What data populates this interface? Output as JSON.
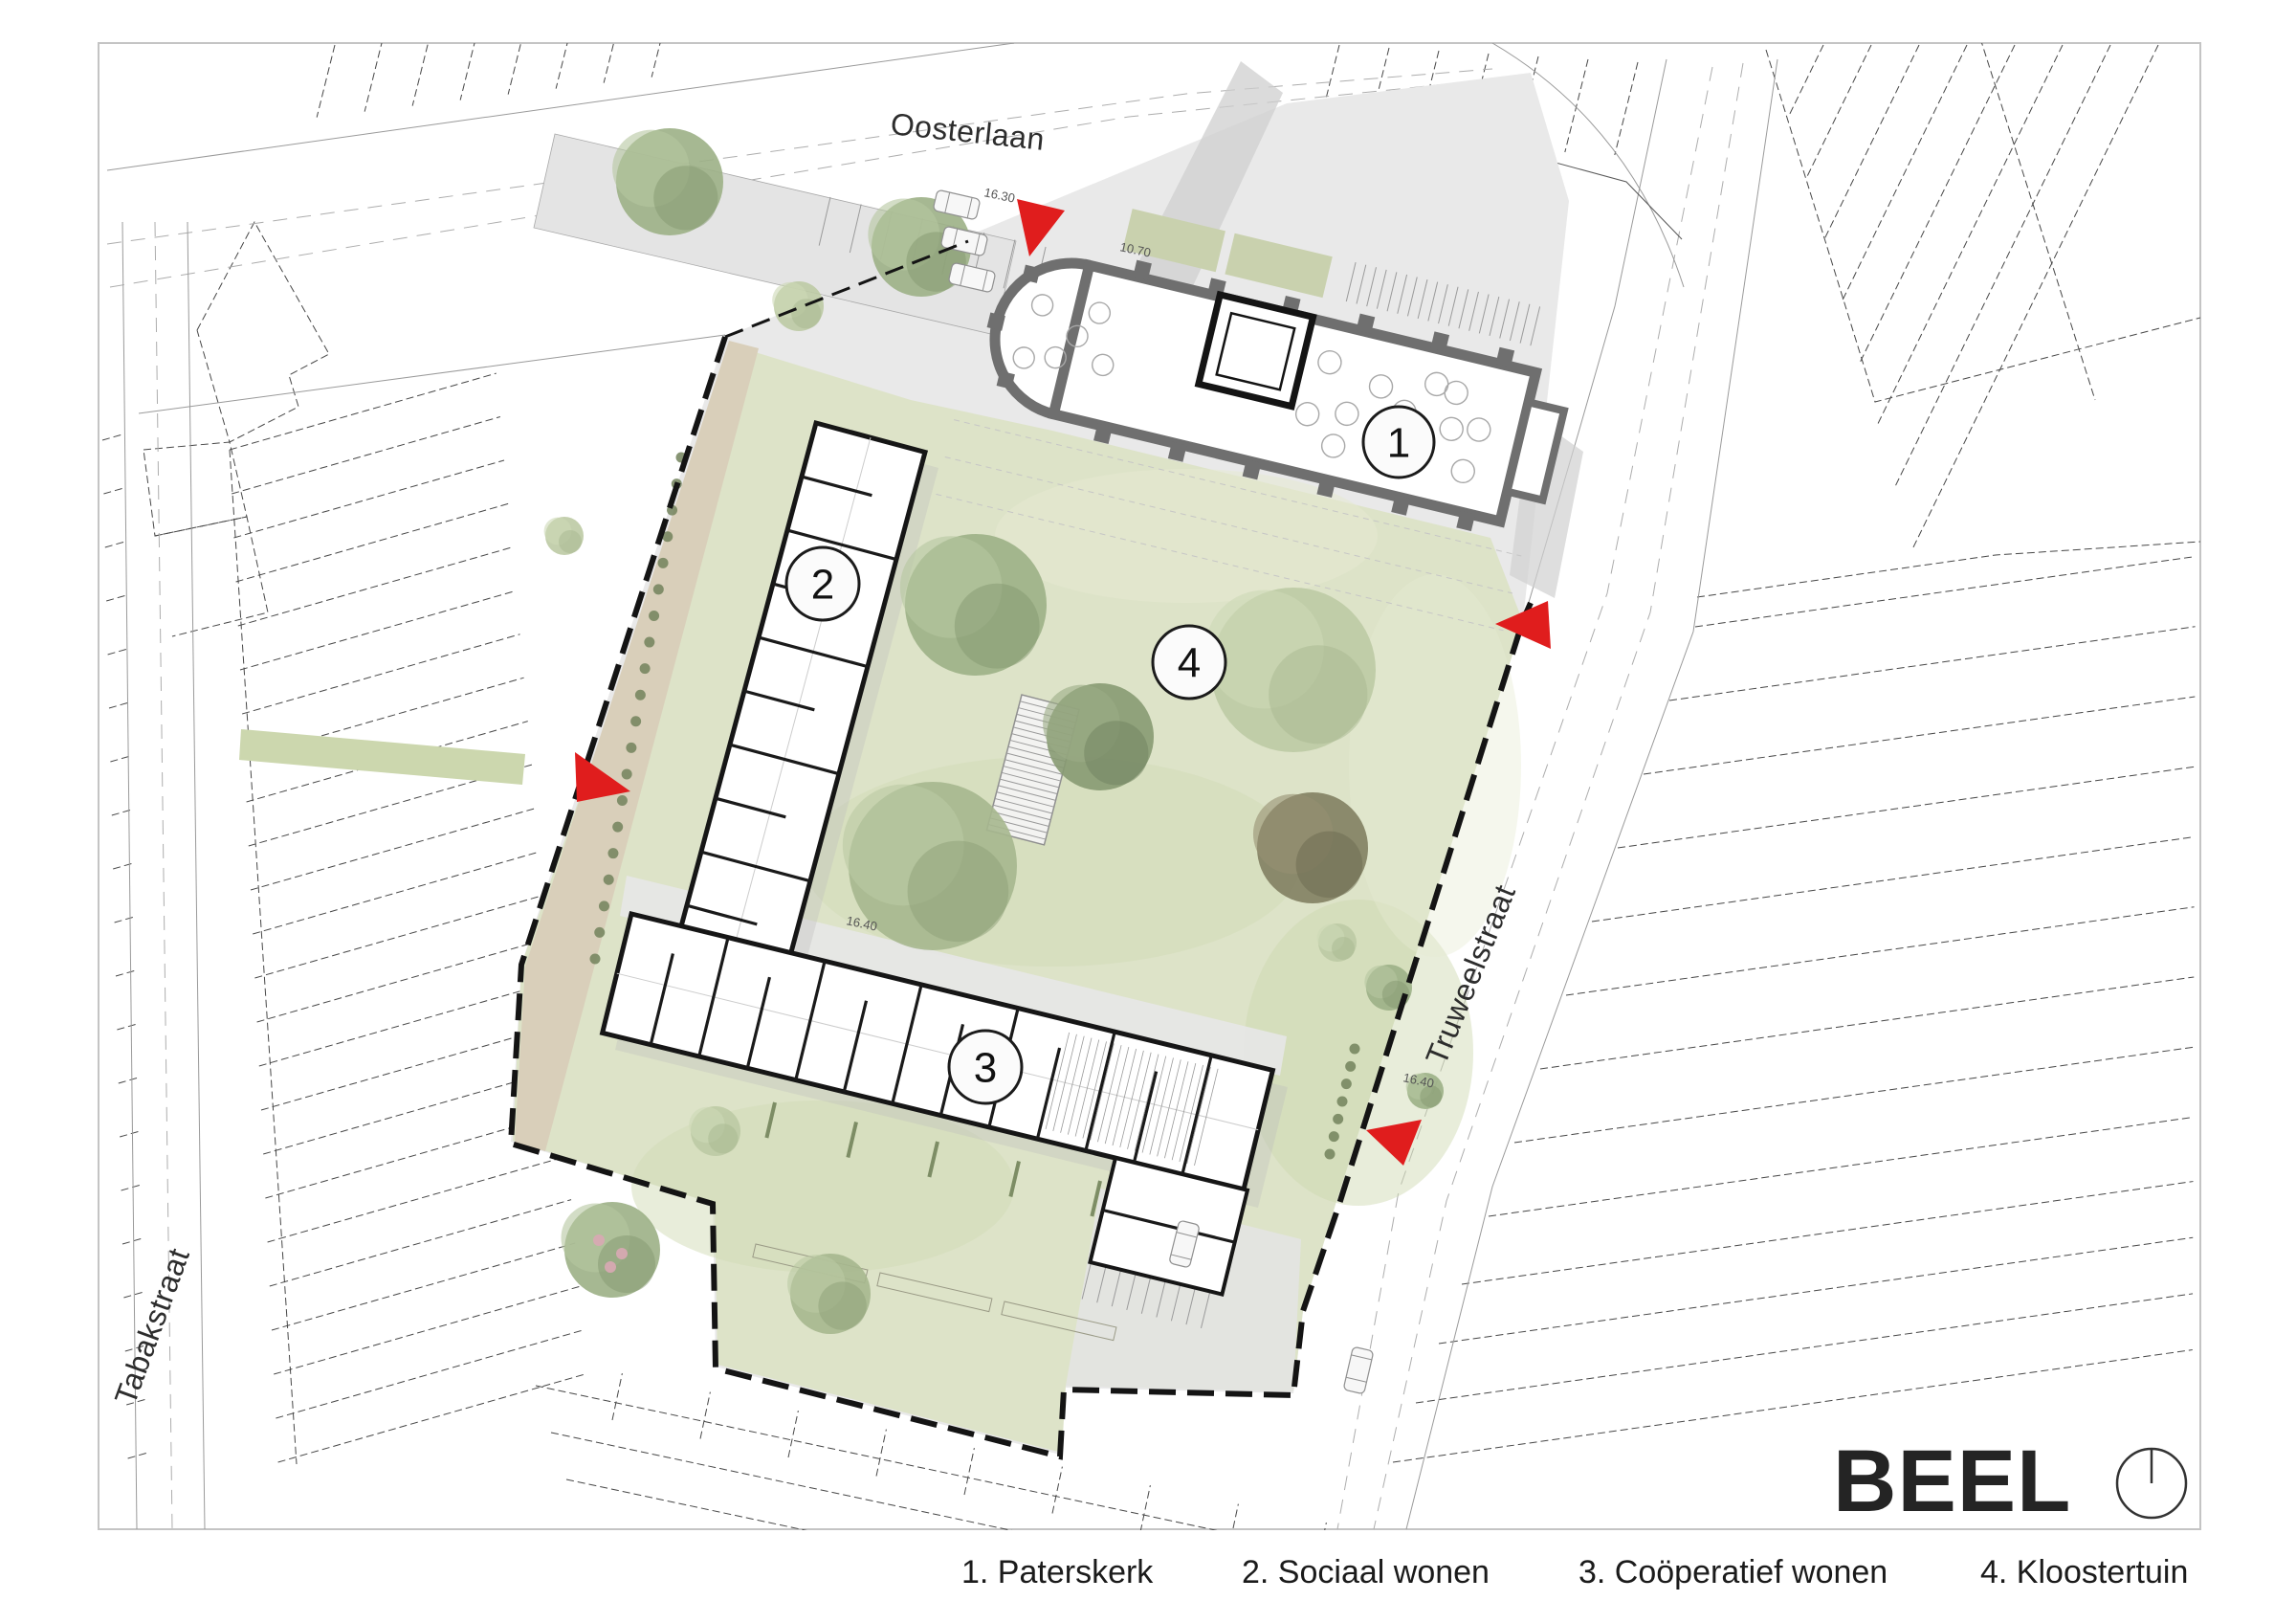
{
  "streets": {
    "oosterlaan": "Oosterlaan",
    "tabakstraat": "Tabakstraat",
    "truweelstraat": "Truweelstraat"
  },
  "legend": {
    "items": [
      {
        "number": "1",
        "text": "1. Paterskerk"
      },
      {
        "number": "2",
        "text": "2. Sociaal wonen"
      },
      {
        "number": "3",
        "text": "3. Coöperatief wonen"
      },
      {
        "number": "4",
        "text": "4. Kloostertuin"
      }
    ]
  },
  "markers": [
    {
      "label": "1",
      "meaning": "Paterskerk"
    },
    {
      "label": "2",
      "meaning": "Sociaal wonen"
    },
    {
      "label": "3",
      "meaning": "Coöperatief wonen"
    },
    {
      "label": "4",
      "meaning": "Kloostertuin"
    }
  ],
  "annotations": [
    {
      "text": "16.30"
    },
    {
      "text": "10.70"
    },
    {
      "text": "16.40"
    },
    {
      "text": "16.40"
    }
  ],
  "logo": {
    "text": "BEEL"
  },
  "icons": {
    "compass": "north-compass-icon"
  },
  "colors": {
    "accent_red": "#e01d1d",
    "garden_green": "#dde3c8",
    "path_tan": "#d9cfba",
    "paving_gray": "#e7e7e7",
    "wall_black": "#161616",
    "church_wall_gray": "#6f6f6f"
  }
}
